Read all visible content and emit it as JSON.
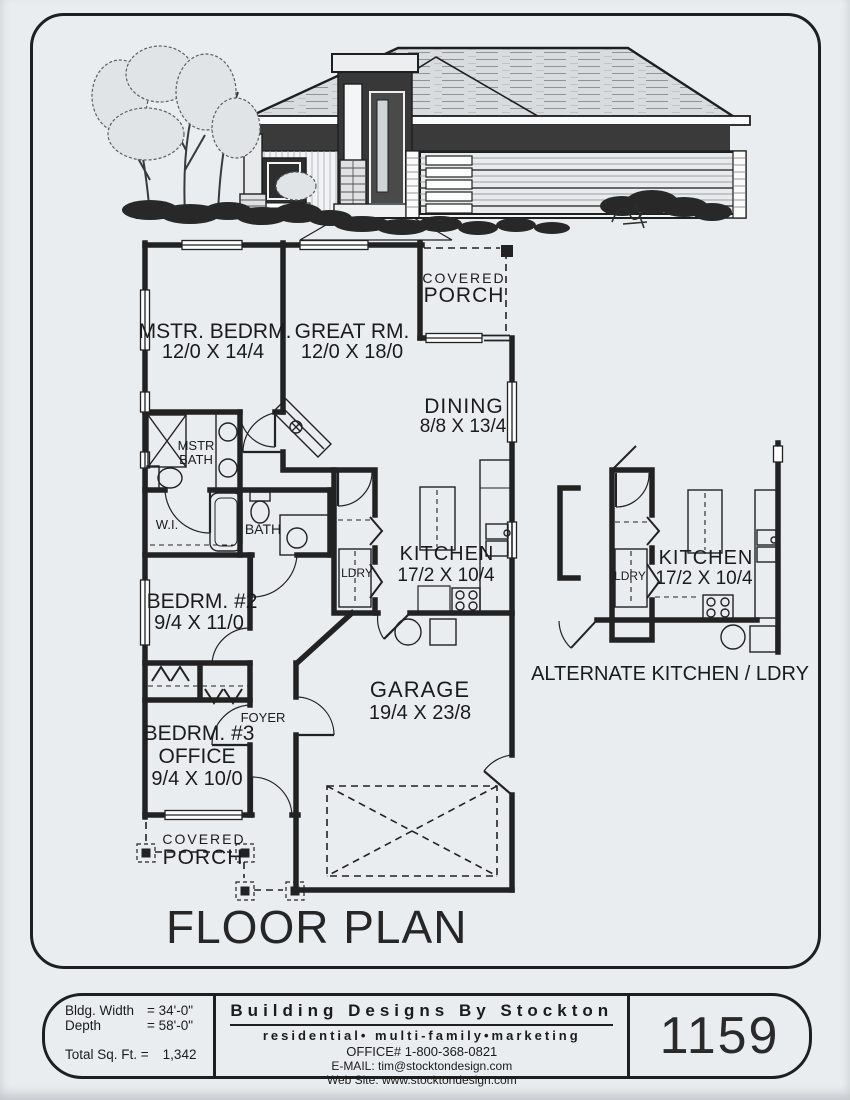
{
  "page": {
    "background": "#e9edf0",
    "ink": "#1f1f1f"
  },
  "floor_plan": {
    "title": "FLOOR PLAN",
    "rooms": {
      "mstr_bedrm": {
        "name": "MSTR. BEDRM.",
        "dims": "12/0 X 14/4"
      },
      "great_rm": {
        "name": "GREAT RM.",
        "dims": "12/0 X 18/0"
      },
      "dining": {
        "name": "DINING",
        "dims": "8/8 X 13/4"
      },
      "kitchen": {
        "name": "KITCHEN",
        "dims": "17/2 X 10/4"
      },
      "bedrm2": {
        "name": "BEDRM. #2",
        "dims": "9/4 X 11/0"
      },
      "bedrm3": {
        "name": "BEDRM. #3",
        "name2": "OFFICE",
        "dims": "9/4 X 10/0"
      },
      "garage": {
        "name": "GARAGE",
        "dims": "19/4 X 23/8"
      }
    },
    "labels": {
      "covered": "COVERED",
      "porch": "PORCH",
      "mstr": "MSTR",
      "bath": "BATH",
      "wi": "W.I.",
      "bath2": "BATH",
      "ldry": "LDRY",
      "foyer": "FOYER"
    },
    "alternate": {
      "kitchen": "KITCHEN",
      "kitchen_dims": "17/2 X 10/4",
      "ldry": "LDRY",
      "caption": "ALTERNATE KITCHEN / LDRY"
    }
  },
  "title_block": {
    "bldg_width_label": "Bldg. Width",
    "bldg_width_value": "= 34'-0\"",
    "depth_label": "Depth",
    "depth_value": "= 58'-0\"",
    "sqft_label": "Total Sq. Ft. =",
    "sqft_value": "1,342",
    "company": "Building Designs By Stockton",
    "tagline": "residential• multi-family•marketing",
    "office": "OFFICE# 1-800-368-0821",
    "email": "E-MAIL: tim@stocktondesign.com",
    "website": "Web Site: www.stocktondesign.com",
    "plan_number": "1159"
  }
}
